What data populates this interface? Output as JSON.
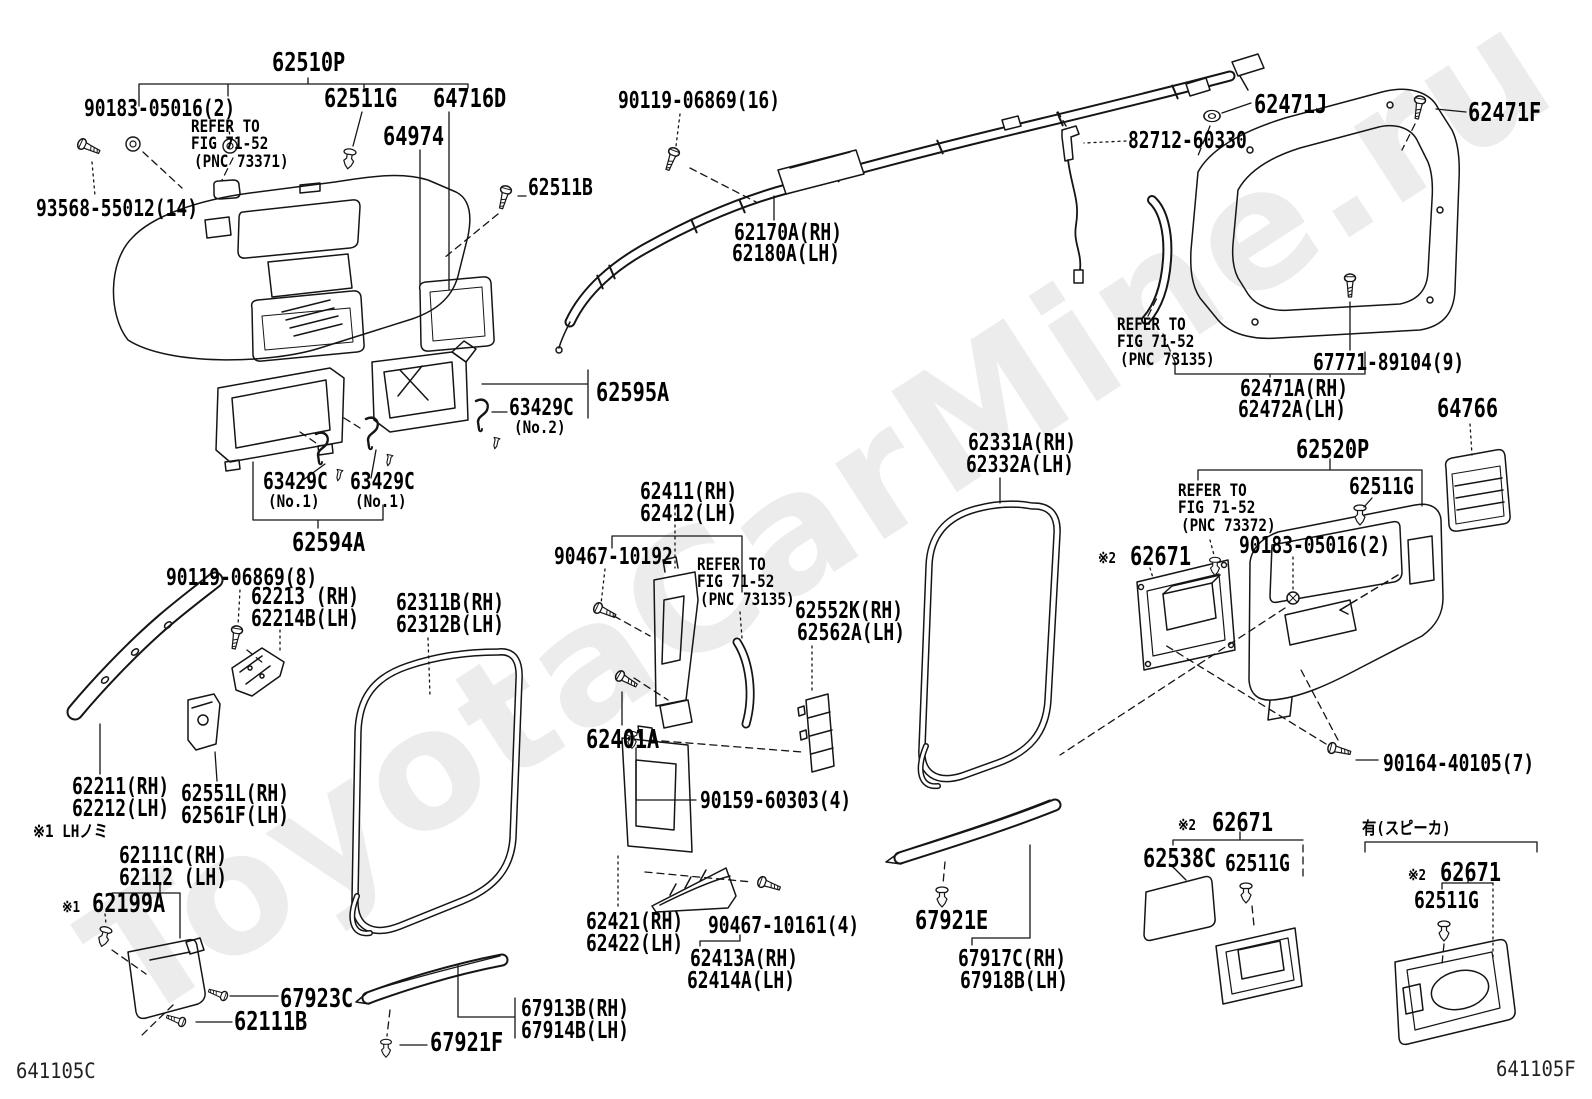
{
  "doc": {
    "watermark": "ToyotaCarMine.ru",
    "code_left": "641105C",
    "code_right": "641105F",
    "line_color": "#151515",
    "background": "#ffffff"
  },
  "labels": [
    {
      "id": "p62510P",
      "text": "62510P",
      "x": 272,
      "y": 50,
      "cls": "xl"
    },
    {
      "id": "n90183a",
      "text": "90183-05016(2)",
      "x": 84,
      "y": 98,
      "cls": "lbl"
    },
    {
      "id": "ref1a",
      "text": "REFER TO",
      "x": 191,
      "y": 119,
      "cls": "sm"
    },
    {
      "id": "ref1b",
      "text": "FIG 71-52",
      "x": 191,
      "y": 136,
      "cls": "sm"
    },
    {
      "id": "ref1c",
      "text": "(PNC 73371)",
      "x": 194,
      "y": 154,
      "cls": "sm"
    },
    {
      "id": "p62511Gt",
      "text": "62511G",
      "x": 324,
      "y": 86,
      "cls": "xl"
    },
    {
      "id": "p64716D",
      "text": "64716D",
      "x": 433,
      "y": 86,
      "cls": "xl"
    },
    {
      "id": "p64974",
      "text": "64974",
      "x": 383,
      "y": 124,
      "cls": "xl"
    },
    {
      "id": "n93568",
      "text": "93568-55012(14)",
      "x": 36,
      "y": 198,
      "cls": "lbl"
    },
    {
      "id": "p62511B",
      "text": "62511B",
      "x": 528,
      "y": 177,
      "cls": "lbl"
    },
    {
      "id": "n90119_16",
      "text": "90119-06869(16)",
      "x": 618,
      "y": 90,
      "cls": "lbl"
    },
    {
      "id": "p62170A",
      "text": "62170A(RH)",
      "x": 734,
      "y": 222,
      "cls": "lbl"
    },
    {
      "id": "p62180A",
      "text": "62180A(LH)",
      "x": 732,
      "y": 243,
      "cls": "lbl"
    },
    {
      "id": "p62471J",
      "text": "62471J",
      "x": 1254,
      "y": 92,
      "cls": "xl"
    },
    {
      "id": "p62471F",
      "text": "62471F",
      "x": 1468,
      "y": 100,
      "cls": "xl"
    },
    {
      "id": "n82712",
      "text": "82712-60330",
      "x": 1128,
      "y": 130,
      "cls": "lbl"
    },
    {
      "id": "ref2a",
      "text": "REFER TO",
      "x": 1117,
      "y": 317,
      "cls": "sm"
    },
    {
      "id": "ref2b",
      "text": "FIG 71-52",
      "x": 1117,
      "y": 334,
      "cls": "sm"
    },
    {
      "id": "ref2c",
      "text": "(PNC 73135)",
      "x": 1120,
      "y": 352,
      "cls": "sm"
    },
    {
      "id": "n67771",
      "text": "67771-89104(9)",
      "x": 1313,
      "y": 352,
      "cls": "lbl"
    },
    {
      "id": "p62471A",
      "text": "62471A(RH)",
      "x": 1240,
      "y": 378,
      "cls": "lbl"
    },
    {
      "id": "p62472A",
      "text": "62472A(LH)",
      "x": 1238,
      "y": 399,
      "cls": "lbl"
    },
    {
      "id": "p64766",
      "text": "64766",
      "x": 1437,
      "y": 396,
      "cls": "xl"
    },
    {
      "id": "p62520P",
      "text": "62520P",
      "x": 1296,
      "y": 437,
      "cls": "xl"
    },
    {
      "id": "p62331A",
      "text": "62331A(RH)",
      "x": 968,
      "y": 432,
      "cls": "lbl"
    },
    {
      "id": "p62332A",
      "text": "62332A(LH)",
      "x": 966,
      "y": 454,
      "cls": "lbl"
    },
    {
      "id": "ref3a",
      "text": "REFER TO",
      "x": 1178,
      "y": 483,
      "cls": "sm"
    },
    {
      "id": "ref3b",
      "text": "FIG 71-52",
      "x": 1178,
      "y": 500,
      "cls": "sm"
    },
    {
      "id": "ref3c",
      "text": "(PNC 73372)",
      "x": 1181,
      "y": 518,
      "cls": "sm"
    },
    {
      "id": "p62511Gr",
      "text": "62511G",
      "x": 1349,
      "y": 476,
      "cls": "lbl"
    },
    {
      "id": "n90183b",
      "text": "90183-05016(2)",
      "x": 1239,
      "y": 535,
      "cls": "lbl"
    },
    {
      "id": "star2a",
      "text": "※2",
      "x": 1098,
      "y": 551,
      "cls": "xs"
    },
    {
      "id": "p62671a",
      "text": "62671",
      "x": 1130,
      "y": 544,
      "cls": "xl"
    },
    {
      "id": "p62595A",
      "text": "62595A",
      "x": 596,
      "y": 380,
      "cls": "xl"
    },
    {
      "id": "p63429Cn2",
      "text": "63429C",
      "x": 509,
      "y": 397,
      "cls": "lbl"
    },
    {
      "id": "no2",
      "text": "(No.2)",
      "x": 514,
      "y": 420,
      "cls": "sm"
    },
    {
      "id": "p63429Ca",
      "text": "63429C",
      "x": 263,
      "y": 471,
      "cls": "lbl"
    },
    {
      "id": "no1a",
      "text": "(No.1)",
      "x": 268,
      "y": 494,
      "cls": "sm"
    },
    {
      "id": "p63429Cb",
      "text": "63429C",
      "x": 350,
      "y": 471,
      "cls": "lbl"
    },
    {
      "id": "no1b",
      "text": "(No.1)",
      "x": 355,
      "y": 494,
      "cls": "sm"
    },
    {
      "id": "p62594A",
      "text": "62594A",
      "x": 292,
      "y": 530,
      "cls": "xl"
    },
    {
      "id": "n90119_8",
      "text": "90119-06869(8)",
      "x": 166,
      "y": 567,
      "cls": "lbl"
    },
    {
      "id": "p62213",
      "text": "62213 (RH)",
      "x": 251,
      "y": 586,
      "cls": "lbl"
    },
    {
      "id": "p62214B",
      "text": "62214B(LH)",
      "x": 251,
      "y": 608,
      "cls": "lbl"
    },
    {
      "id": "p62311B",
      "text": "62311B(RH)",
      "x": 396,
      "y": 592,
      "cls": "lbl"
    },
    {
      "id": "p62312B",
      "text": "62312B(LH)",
      "x": 396,
      "y": 614,
      "cls": "lbl"
    },
    {
      "id": "p62411",
      "text": "62411(RH)",
      "x": 640,
      "y": 481,
      "cls": "lbl"
    },
    {
      "id": "p62412",
      "text": "62412(LH)",
      "x": 640,
      "y": 503,
      "cls": "lbl"
    },
    {
      "id": "n90467a",
      "text": "90467-10192",
      "x": 554,
      "y": 546,
      "cls": "lbl"
    },
    {
      "id": "ref4a",
      "text": "REFER TO",
      "x": 697,
      "y": 557,
      "cls": "sm"
    },
    {
      "id": "ref4b",
      "text": "FIG 71-52",
      "x": 697,
      "y": 574,
      "cls": "sm"
    },
    {
      "id": "ref4c",
      "text": "(PNC 73135)",
      "x": 700,
      "y": 592,
      "cls": "sm"
    },
    {
      "id": "p62552K",
      "text": "62552K(RH)",
      "x": 795,
      "y": 600,
      "cls": "lbl"
    },
    {
      "id": "p62562A",
      "text": "62562A(LH)",
      "x": 797,
      "y": 622,
      "cls": "lbl"
    },
    {
      "id": "p62401A",
      "text": "62401A",
      "x": 586,
      "y": 727,
      "cls": "xl"
    },
    {
      "id": "n90159",
      "text": "90159-60303(4)",
      "x": 700,
      "y": 790,
      "cls": "lbl"
    },
    {
      "id": "p62211",
      "text": "62211(RH)",
      "x": 72,
      "y": 776,
      "cls": "lbl"
    },
    {
      "id": "p62212",
      "text": "62212(LH)",
      "x": 72,
      "y": 798,
      "cls": "lbl"
    },
    {
      "id": "p62551L",
      "text": "62551L(RH)",
      "x": 181,
      "y": 783,
      "cls": "lbl"
    },
    {
      "id": "p62561F",
      "text": "62561F(LH)",
      "x": 181,
      "y": 805,
      "cls": "lbl"
    },
    {
      "id": "note1",
      "text": "※1 LHノミ",
      "x": 33,
      "y": 824,
      "cls": "sm"
    },
    {
      "id": "p62111C",
      "text": "62111C(RH)",
      "x": 119,
      "y": 845,
      "cls": "lbl"
    },
    {
      "id": "p62112",
      "text": "62112 (LH)",
      "x": 119,
      "y": 867,
      "cls": "lbl"
    },
    {
      "id": "star1b",
      "text": "※1",
      "x": 62,
      "y": 900,
      "cls": "xs"
    },
    {
      "id": "p62199A",
      "text": "62199A",
      "x": 92,
      "y": 891,
      "cls": "xl"
    },
    {
      "id": "p67923C",
      "text": "67923C",
      "x": 280,
      "y": 986,
      "cls": "xl"
    },
    {
      "id": "p62111B",
      "text": "62111B",
      "x": 234,
      "y": 1009,
      "cls": "xl"
    },
    {
      "id": "p67921F",
      "text": "67921F",
      "x": 430,
      "y": 1030,
      "cls": "xl"
    },
    {
      "id": "p67913B",
      "text": "67913B(RH)",
      "x": 521,
      "y": 998,
      "cls": "lbl"
    },
    {
      "id": "p67914B",
      "text": "67914B(LH)",
      "x": 521,
      "y": 1020,
      "cls": "lbl"
    },
    {
      "id": "p62421",
      "text": "62421(RH)",
      "x": 586,
      "y": 911,
      "cls": "lbl"
    },
    {
      "id": "p62422",
      "text": "62422(LH)",
      "x": 586,
      "y": 933,
      "cls": "lbl"
    },
    {
      "id": "n90467b",
      "text": "90467-10161(4)",
      "x": 708,
      "y": 915,
      "cls": "lbl"
    },
    {
      "id": "p62413A",
      "text": "62413A(RH)",
      "x": 690,
      "y": 948,
      "cls": "lbl"
    },
    {
      "id": "p62414A",
      "text": "62414A(LH)",
      "x": 687,
      "y": 970,
      "cls": "lbl"
    },
    {
      "id": "p67921E",
      "text": "67921E",
      "x": 915,
      "y": 908,
      "cls": "xl"
    },
    {
      "id": "p67917C",
      "text": "67917C(RH)",
      "x": 958,
      "y": 948,
      "cls": "lbl"
    },
    {
      "id": "p67918B",
      "text": "67918B(LH)",
      "x": 960,
      "y": 970,
      "cls": "lbl"
    },
    {
      "id": "star2b",
      "text": "※2",
      "x": 1178,
      "y": 818,
      "cls": "xs"
    },
    {
      "id": "p62671b",
      "text": "62671",
      "x": 1212,
      "y": 810,
      "cls": "xl"
    },
    {
      "id": "p62538C",
      "text": "62538C",
      "x": 1143,
      "y": 846,
      "cls": "xl"
    },
    {
      "id": "p62511Gm",
      "text": "62511G",
      "x": 1225,
      "y": 853,
      "cls": "lbl"
    },
    {
      "id": "n90164",
      "text": "90164-40105(7)",
      "x": 1383,
      "y": 753,
      "cls": "lbl"
    },
    {
      "id": "note2",
      "text": "有(スピーカ)",
      "x": 1362,
      "y": 821,
      "cls": "sm"
    },
    {
      "id": "star2c",
      "text": "※2",
      "x": 1408,
      "y": 868,
      "cls": "xs"
    },
    {
      "id": "p62671c",
      "text": "62671",
      "x": 1440,
      "y": 860,
      "cls": "xl"
    },
    {
      "id": "p62511Gb",
      "text": "62511G",
      "x": 1414,
      "y": 890,
      "cls": "lbl"
    }
  ]
}
